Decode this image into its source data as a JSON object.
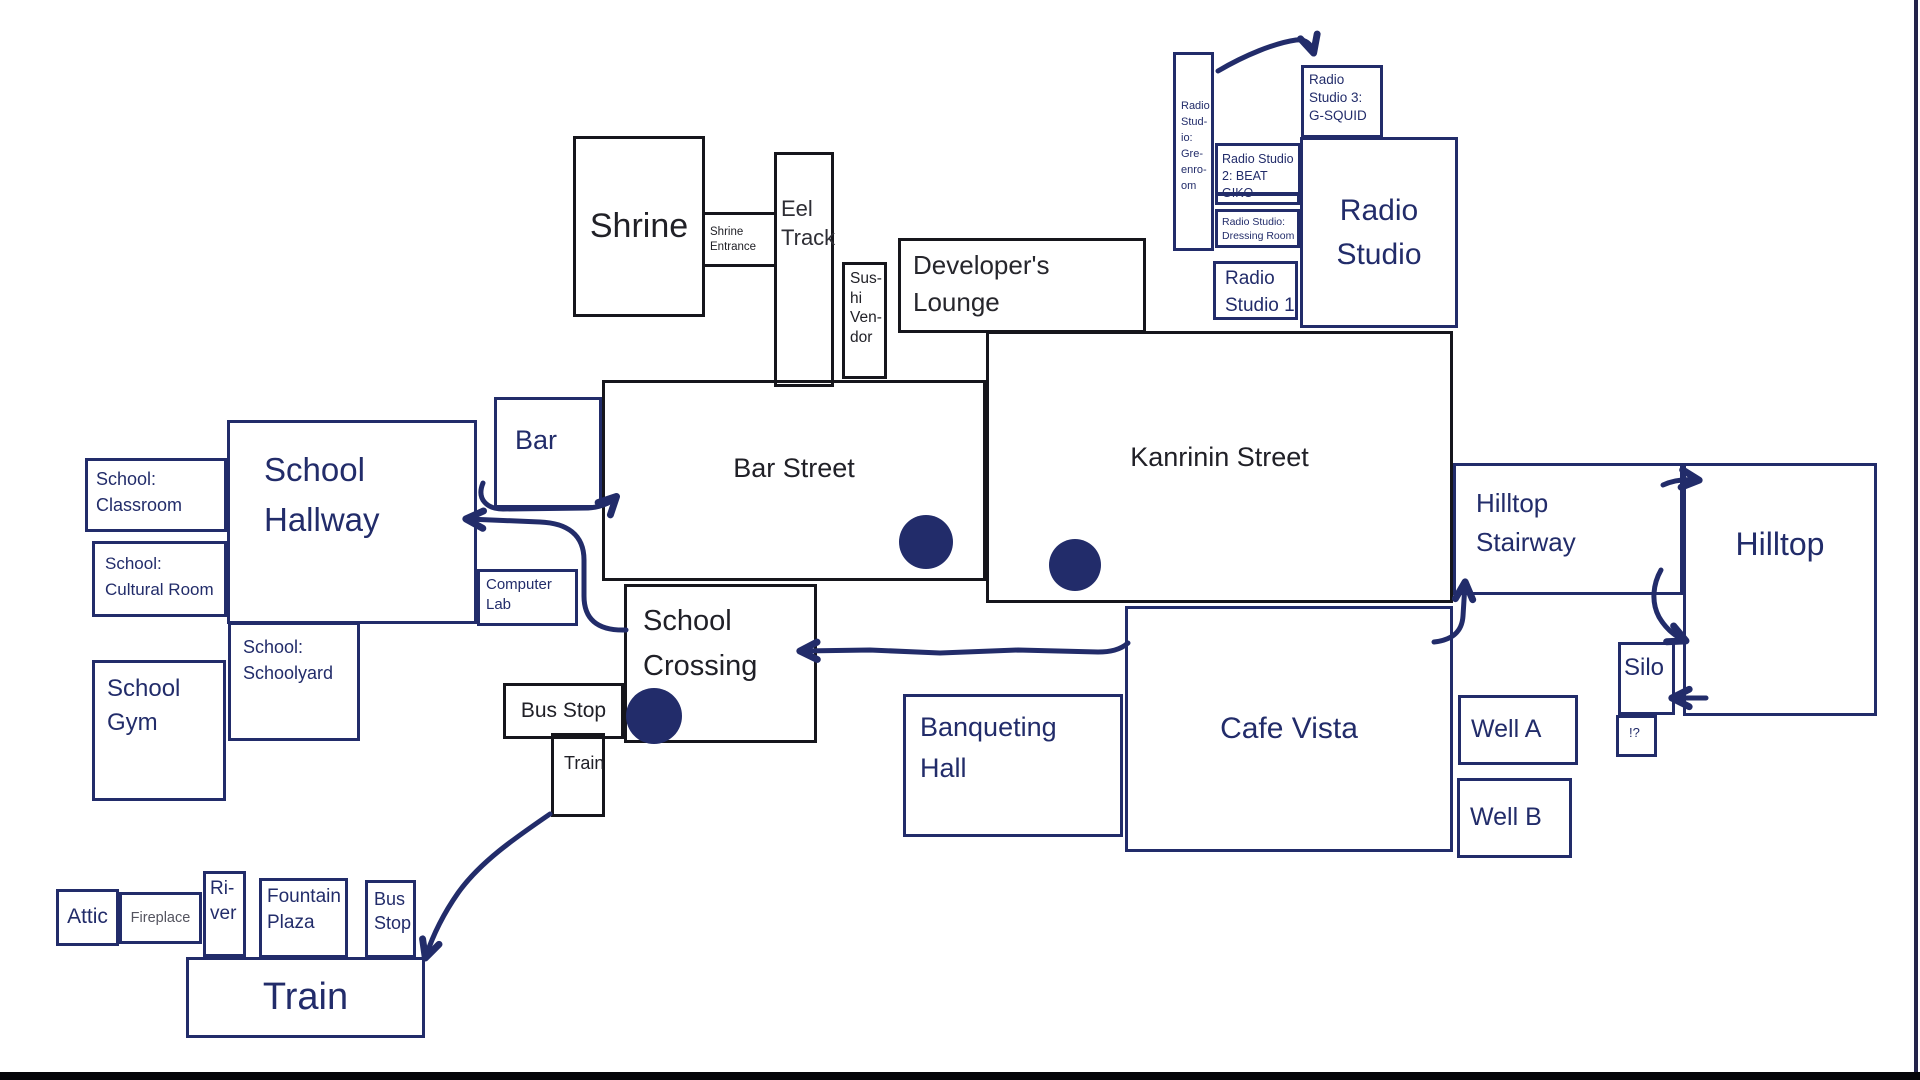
{
  "palette": {
    "ink_blue": "#222c6a",
    "ink_black": "#16161c",
    "text_gray": "#55555e",
    "background": "#ffffff"
  },
  "rooms": {
    "shrine": {
      "label": "Shrine"
    },
    "shrine_entrance": {
      "label": "Shrine\nEntrance"
    },
    "eel_track": {
      "label": "Eel\nTrack"
    },
    "sushi_vendor": {
      "label": "Sus-\nhi\nVen-\ndor"
    },
    "developers_lounge": {
      "label": "Developer's\nLounge"
    },
    "bar_street": {
      "label": "Bar Street"
    },
    "kanrinin_street": {
      "label": "Kanrinin Street"
    },
    "school_crossing": {
      "label": "School\nCrossing"
    },
    "bus_stop_top": {
      "label": "Bus Stop"
    },
    "train_small": {
      "label": "Train"
    },
    "radio_greenroom": {
      "label": "Radio\nStud-\nio:\nGre-\nenro-\nom"
    },
    "radio_studio3": {
      "label": "Radio\nStudio 3:\nG-SQUID"
    },
    "radio_studio2": {
      "label": "Radio Studio\n2: BEAT GIKO"
    },
    "radio_dressing": {
      "label": "Radio Studio:\nDressing Room"
    },
    "radio_studio1": {
      "label": "Radio\nStudio 1"
    },
    "radio_studio_main": {
      "label": "Radio\nStudio"
    },
    "bar": {
      "label": "Bar"
    },
    "school_classroom": {
      "label": "School:\nClassroom"
    },
    "school_cultural": {
      "label": "School:\nCultural Room"
    },
    "school_hallway": {
      "label": "School\nHallway"
    },
    "school_schoolyard": {
      "label": "School:\nSchoolyard"
    },
    "school_gym": {
      "label": "School\nGym"
    },
    "computer_lab": {
      "label": "Computer\nLab"
    },
    "banqueting_hall": {
      "label": "Banqueting\nHall"
    },
    "cafe_vista": {
      "label": "Cafe Vista"
    },
    "well_a": {
      "label": "Well A"
    },
    "well_b": {
      "label": "Well B"
    },
    "hilltop_stairway": {
      "label": "Hilltop\nStairway"
    },
    "hilltop": {
      "label": "Hilltop"
    },
    "silo": {
      "label": "Silo"
    },
    "unknown_room": {
      "label": "!?"
    },
    "attic": {
      "label": "Attic"
    },
    "fireplace": {
      "label": "Fireplace"
    },
    "river": {
      "label": "Ri-\nver"
    },
    "fountain_plaza": {
      "label": "Fountain\nPlaza"
    },
    "bus_stop_bottom": {
      "label": "Bus\nStop"
    },
    "train_big": {
      "label": "Train"
    }
  },
  "arrows": [
    {
      "from": "radio-greenroom",
      "to": "radio-studio-3"
    },
    {
      "from": "bar",
      "to": "bar-street"
    },
    {
      "from": "school-crossing",
      "to": "school-hallway"
    },
    {
      "from": "cafe-vista",
      "to": "school-crossing"
    },
    {
      "from": "cafe-vista-corner",
      "to": "hilltop-stairway"
    },
    {
      "from": "hilltop-stairway",
      "to": "hilltop"
    },
    {
      "from": "hilltop",
      "to": "silo-junction"
    },
    {
      "from": "hilltop",
      "to": "silo"
    },
    {
      "from": "train-small",
      "to": "train-big"
    }
  ],
  "dots": [
    {
      "location": "bar-street"
    },
    {
      "location": "kanrinin-street"
    },
    {
      "location": "school-crossing"
    }
  ]
}
